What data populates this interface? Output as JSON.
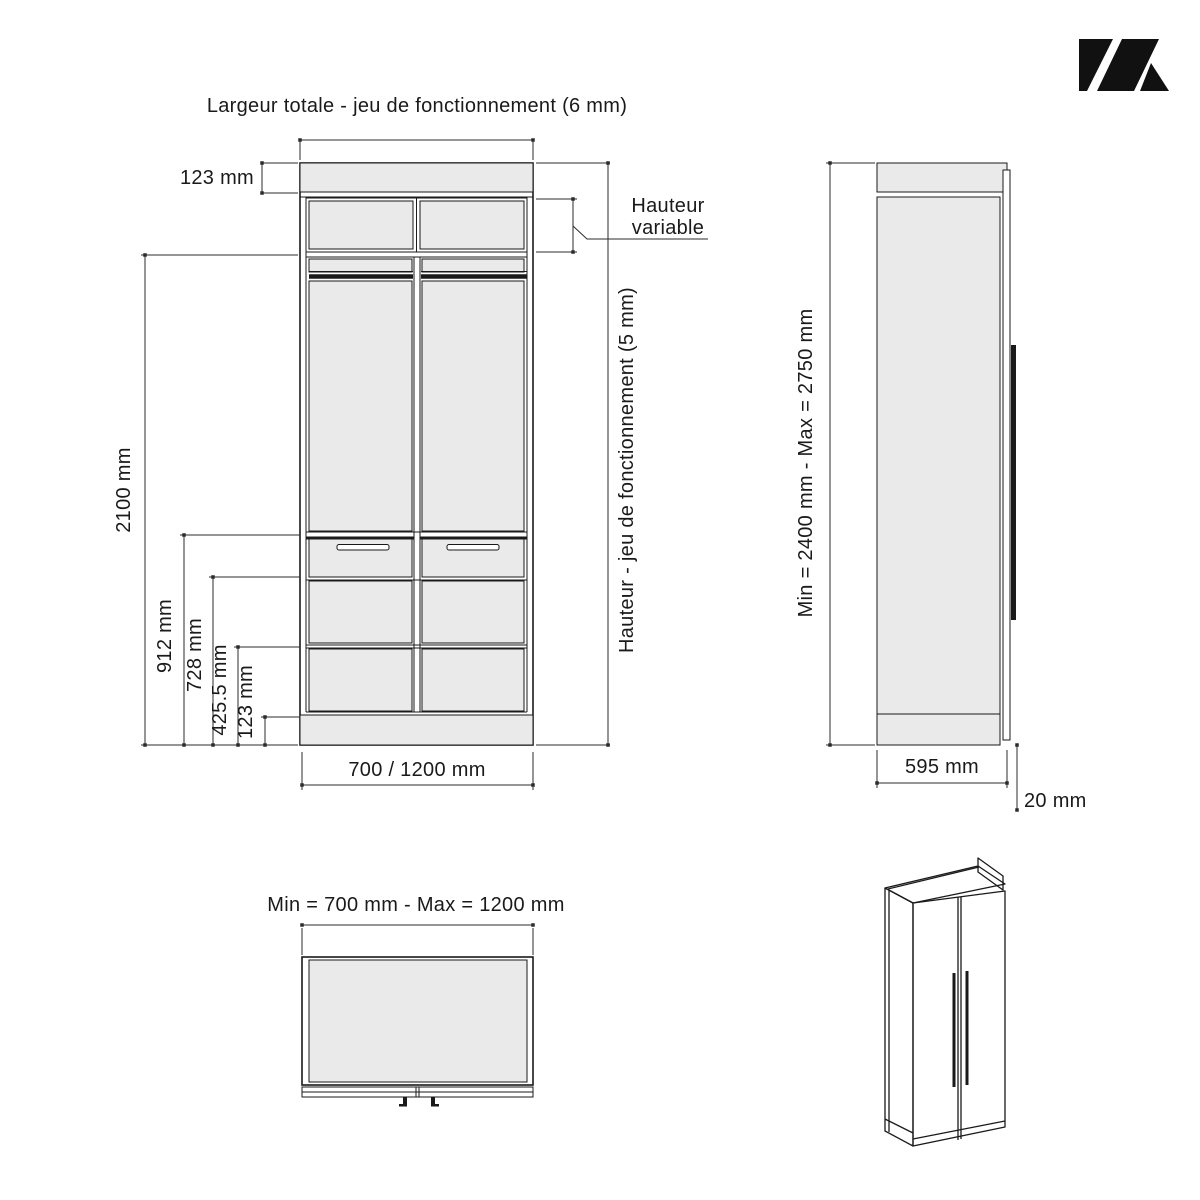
{
  "colors": {
    "line": "#1a1a1a",
    "dim": "#2b2b2b",
    "panel": "#eaeaea",
    "logo": "#111111"
  },
  "brand": {
    "logo_icon": "k-mark-logo"
  },
  "front_view": {
    "title": "Largeur totale - jeu de fonctionnement (6 mm)",
    "dim_top_cap": "123 mm",
    "variable_label_line1": "Hauteur",
    "variable_label_line2": "variable",
    "dim_height_clearance": "Hauteur - jeu de fonctionnement (5 mm)",
    "dim_total_height": "2100 mm",
    "dim_912": "912 mm",
    "dim_728": "728 mm",
    "dim_425": "425.5 mm",
    "dim_plinth": "123 mm",
    "dim_width": "700 / 1200 mm"
  },
  "side_view": {
    "dim_height": "Min = 2400 mm - Max = 2750 mm",
    "dim_depth": "595 mm",
    "dim_door_thickness": "20 mm"
  },
  "top_view": {
    "title": "Min = 700 mm - Max = 1200 mm"
  }
}
